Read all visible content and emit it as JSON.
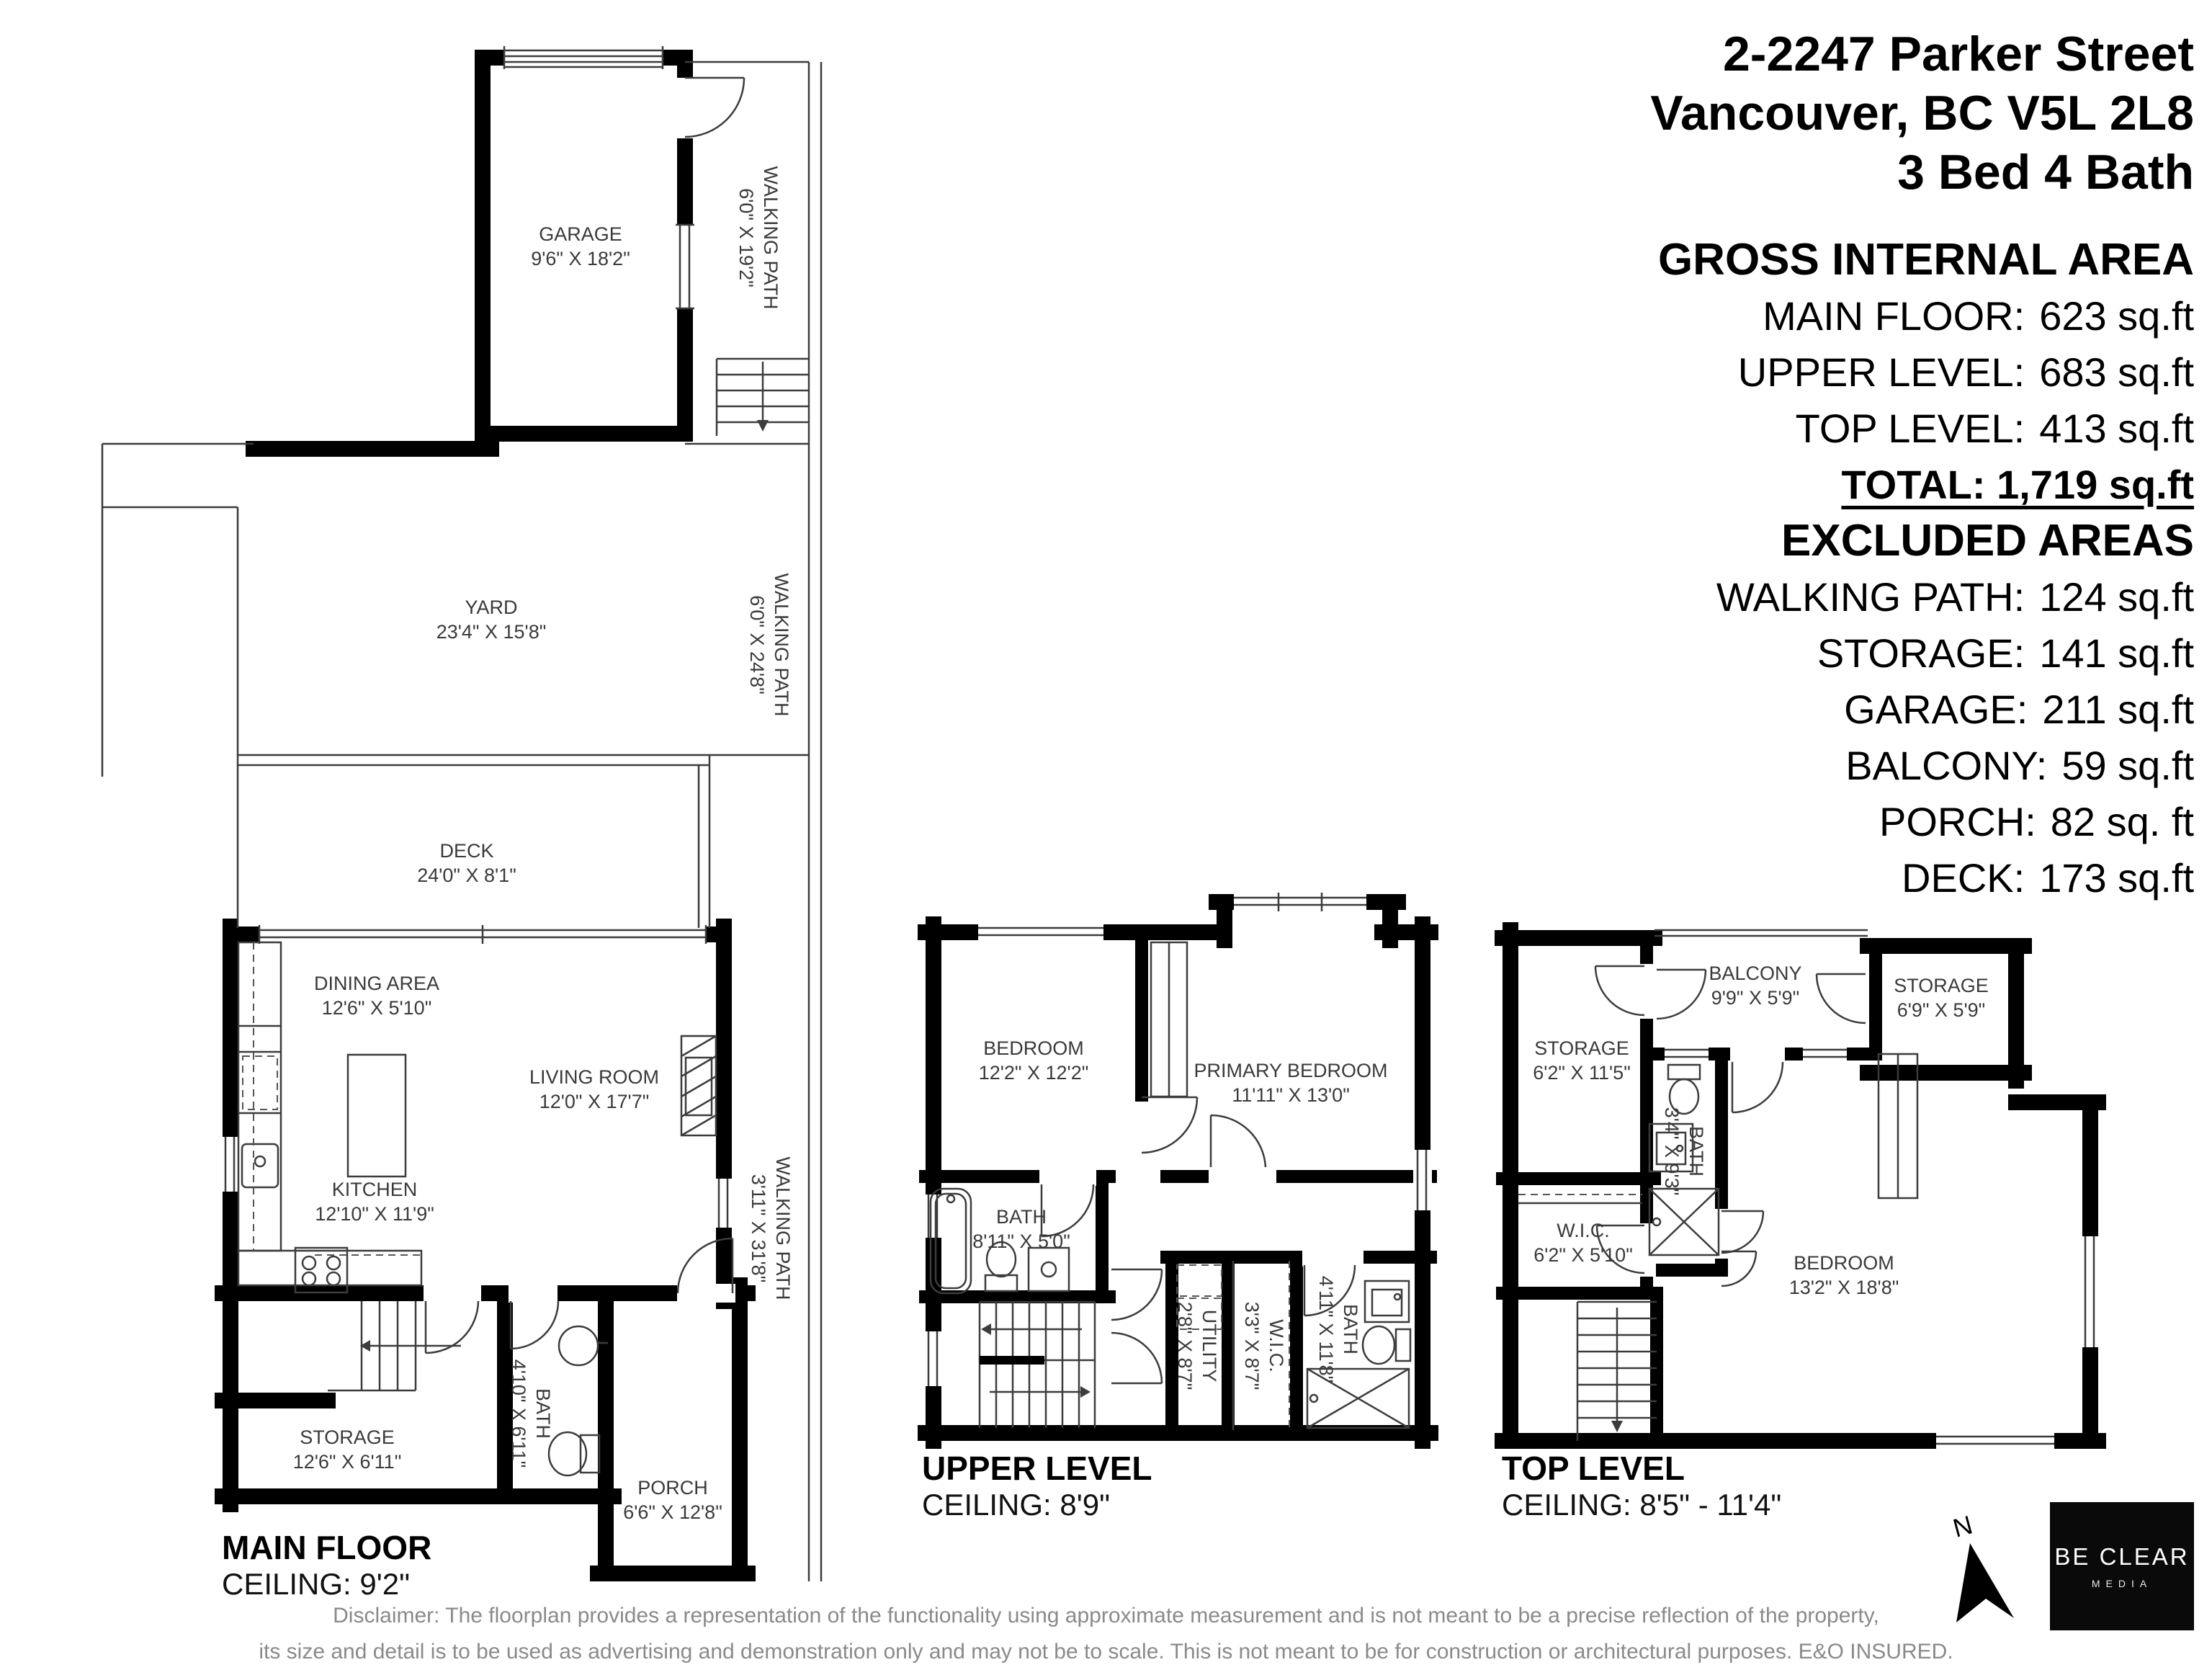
{
  "header": {
    "address_line1": "2-2247 Parker Street",
    "address_line2": "Vancouver, BC V5L 2L8",
    "address_line3": "3 Bed 4 Bath"
  },
  "areas": {
    "title": "GROSS INTERNAL AREA",
    "rows": [
      {
        "label": "MAIN FLOOR:",
        "value": "623 sq.ft"
      },
      {
        "label": "UPPER LEVEL:",
        "value": "683 sq.ft"
      },
      {
        "label": "TOP LEVEL:",
        "value": "413 sq.ft"
      }
    ],
    "total": "TOTAL: 1,719 sq.ft",
    "excluded_title": "EXCLUDED AREAS",
    "excluded_rows": [
      {
        "label": "WALKING PATH:",
        "value": "124 sq.ft"
      },
      {
        "label": "STORAGE:",
        "value": "141 sq.ft"
      },
      {
        "label": "GARAGE:",
        "value": "211 sq.ft"
      },
      {
        "label": "BALCONY:",
        "value": "59 sq.ft"
      },
      {
        "label": "PORCH:",
        "value": "82 sq. ft"
      },
      {
        "label": "DECK:",
        "value": "173 sq.ft"
      }
    ]
  },
  "plans": {
    "main": {
      "title": "MAIN FLOOR",
      "ceiling": "CEILING: 9'2\"",
      "rooms": {
        "garage": {
          "name": "GARAGE",
          "dims": "9'6\" X 18'2\""
        },
        "wpath_a": {
          "name": "WALKING PATH",
          "dims": "6'0\" X 19'2\""
        },
        "yard": {
          "name": "YARD",
          "dims": "23'4\" X 15'8\""
        },
        "wpath_b": {
          "name": "WALKING PATH",
          "dims": "6'0\" X 24'8\""
        },
        "deck": {
          "name": "DECK",
          "dims": "24'0\" X 8'1\""
        },
        "dining": {
          "name": "DINING AREA",
          "dims": "12'6\" X 5'10\""
        },
        "living": {
          "name": "LIVING ROOM",
          "dims": "12'0\" X 17'7\""
        },
        "kitchen": {
          "name": "KITCHEN",
          "dims": "12'10\" X 11'9\""
        },
        "wpath_c": {
          "name": "WALKING PATH",
          "dims": "3'11\" X 31'8\""
        },
        "storage": {
          "name": "STORAGE",
          "dims": "12'6\" X 6'11\""
        },
        "bath": {
          "name": "BATH",
          "dims": "4'10\" X 6'11\""
        },
        "porch": {
          "name": "PORCH",
          "dims": "6'6\" X 12'8\""
        }
      }
    },
    "upper": {
      "title": "UPPER LEVEL",
      "ceiling": "CEILING: 8'9\"",
      "rooms": {
        "bedroom": {
          "name": "BEDROOM",
          "dims": "12'2\" X 12'2\""
        },
        "primary": {
          "name": "PRIMARY BEDROOM",
          "dims": "11'11\" X 13'0\""
        },
        "bath": {
          "name": "BATH",
          "dims": "8'11\" X 5'0\""
        },
        "utility": {
          "name": "UTILITY",
          "dims": "2'8\" X 8'7\""
        },
        "wic": {
          "name": "W.I.C.",
          "dims": "3'3\" X 8'7\""
        },
        "bath2": {
          "name": "BATH",
          "dims": "4'11\" X 11'8\""
        }
      }
    },
    "top": {
      "title": "TOP LEVEL",
      "ceiling": "CEILING: 8'5\" - 11'4\"",
      "rooms": {
        "storage_left": {
          "name": "STORAGE",
          "dims": "6'2\" X 11'5\""
        },
        "balcony": {
          "name": "BALCONY",
          "dims": "9'9\" X 5'9\""
        },
        "storage_right": {
          "name": "STORAGE",
          "dims": "6'9\" X 5'9\""
        },
        "bath": {
          "name": "BATH",
          "dims": "3'4\" X 9'3\""
        },
        "wic": {
          "name": "W.I.C.",
          "dims": "6'2\" X 5'10\""
        },
        "bedroom": {
          "name": "BEDROOM",
          "dims": "13'2\" X 18'8\""
        }
      }
    }
  },
  "compass": {
    "label": "N"
  },
  "logo": {
    "line1": "BE CLEAR",
    "line2": "MEDIA"
  },
  "disclaimer": {
    "line1": "Disclaimer: The floorplan provides a representation of the functionality using approximate measurement and is not meant to be a precise reflection of the property,",
    "line2": "its size and detail is to be used as advertising and demonstration only and may not be to scale. This is not meant to be for construction or architectural purposes. E&O INSURED."
  }
}
